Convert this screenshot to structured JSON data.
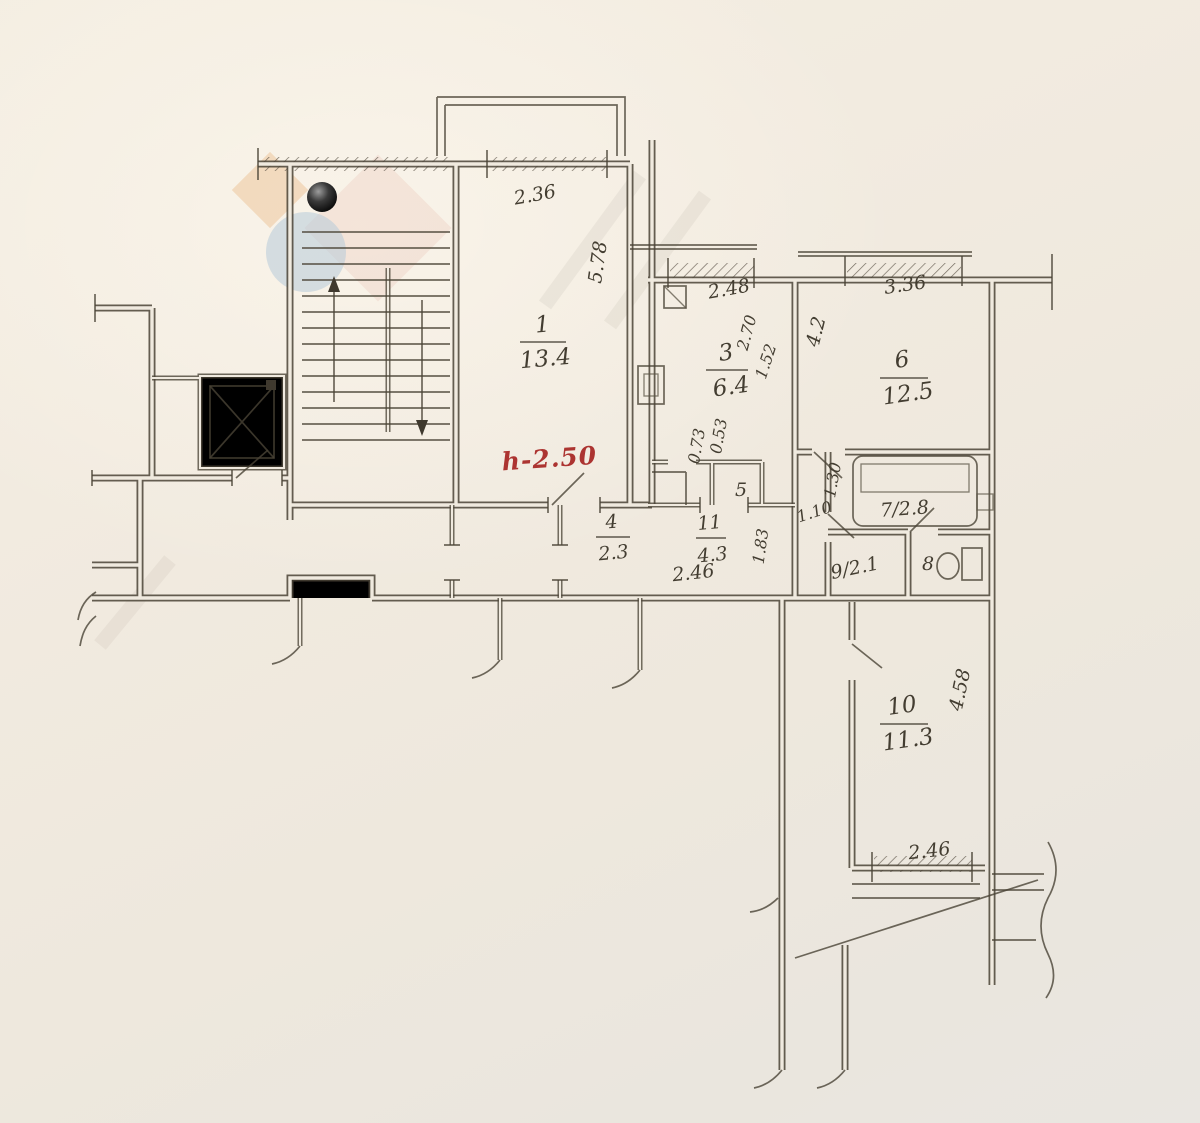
{
  "document_kind": "hand-drawn apartment floor plan (scanned)",
  "palette": {
    "paper": "#f1ebe1",
    "ink": "#4a4336",
    "red_note": "#ac3431",
    "watermark_orange": "#eec9a4",
    "watermark_pink": "#ecc9bd",
    "watermark_blue": "#b6cad9"
  },
  "height_note": {
    "text": "h-2.50"
  },
  "rooms": [
    {
      "id": "1",
      "number": "1",
      "area": "13.4"
    },
    {
      "id": "3",
      "number": "3",
      "area": "6.4"
    },
    {
      "id": "4",
      "number": "4",
      "area": "2.3"
    },
    {
      "id": "5",
      "number": "5"
    },
    {
      "id": "6",
      "number": "6",
      "area": "12.5"
    },
    {
      "id": "7",
      "label": "7/2.8"
    },
    {
      "id": "8",
      "number": "8"
    },
    {
      "id": "9",
      "label": "9/2.1"
    },
    {
      "id": "10",
      "number": "10",
      "area": "11.3"
    },
    {
      "id": "11",
      "number": "11",
      "area": "4.3"
    }
  ],
  "dimensions": [
    {
      "along": "room-1-top",
      "text": "2.36"
    },
    {
      "along": "room-1-right",
      "text": "5.78"
    },
    {
      "along": "room-3-top",
      "text": "2.48"
    },
    {
      "along": "room-3-right",
      "text": "2.70"
    },
    {
      "along": "room-3-right-2",
      "text": "1.52"
    },
    {
      "along": "room-6-top",
      "text": "3.36"
    },
    {
      "along": "room-6-left",
      "text": "4.2"
    },
    {
      "along": "room-3-door-pier",
      "text": "0.73"
    },
    {
      "along": "room-3-door",
      "text": "0.53"
    },
    {
      "along": "bath-left",
      "text": "1.30"
    },
    {
      "along": "bath-door",
      "text": "1.10"
    },
    {
      "along": "hall-11-right",
      "text": "1.83"
    },
    {
      "along": "hall-11-bottom",
      "text": "2.46"
    },
    {
      "along": "room-10-bottom",
      "text": "2.46"
    },
    {
      "along": "room-10-right",
      "text": "4.58"
    }
  ]
}
